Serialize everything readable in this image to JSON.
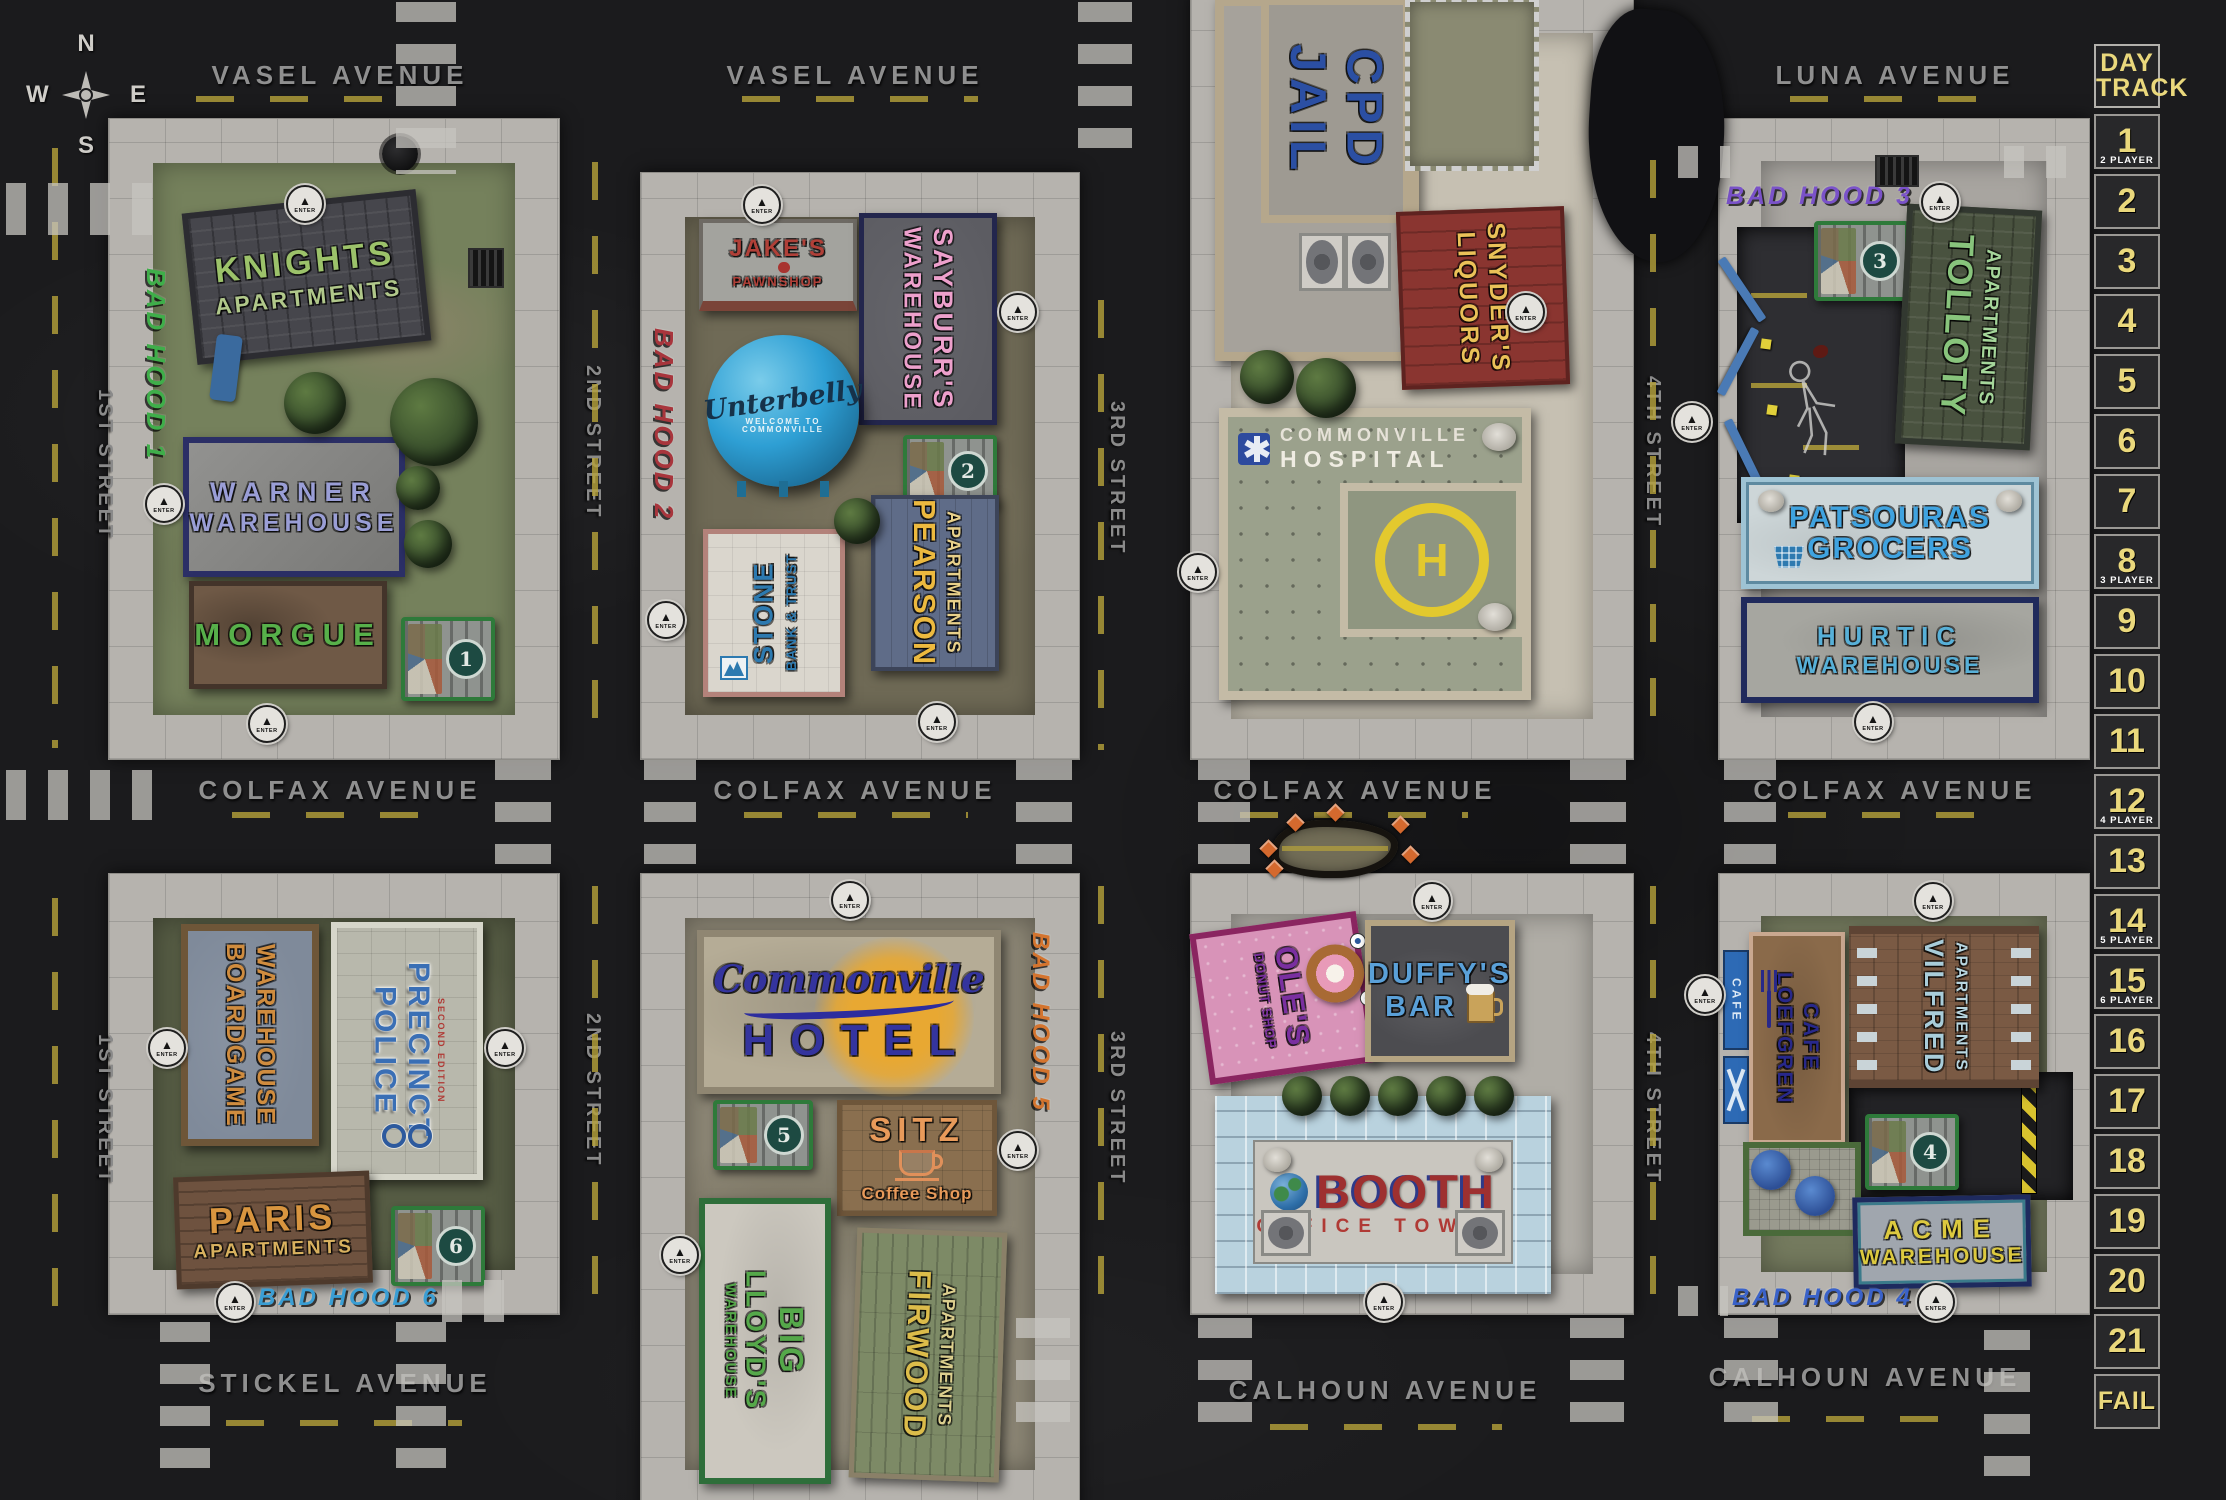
{
  "palette": {
    "asphalt": "#1b1b1d",
    "sidewalk": "#b6b3ae",
    "track_yellow": "#ead87c",
    "dash_yellow": "#b6a23a",
    "enter_marker": "#e4e2dd"
  },
  "compass": {
    "n": "N",
    "e": "E",
    "s": "S",
    "w": "W"
  },
  "streets": {
    "vasel_w": "VASEL AVENUE",
    "vasel_e": "VASEL AVENUE",
    "luna": "LUNA AVENUE",
    "colfax_1": "COLFAX AVENUE",
    "colfax_2": "COLFAX AVENUE",
    "colfax_3": "COLFAX AVENUE",
    "colfax_4": "COLFAX AVENUE",
    "stickel": "STICKEL AVENUE",
    "calhoun_1": "CALHOUN AVENUE",
    "calhoun_2": "CALHOUN AVENUE",
    "first_u": "1ST STREET",
    "first_l": "1ST STREET",
    "second_u": "2ND STREET",
    "second_l": "2ND STREET",
    "third_u": "3RD STREET",
    "third_l": "3RD STREET",
    "fourth_u": "4TH STREET",
    "fourth_l": "4TH STREET"
  },
  "graffiti": {
    "hood1": "BAD HOOD 1",
    "hood2": "BAD HOOD 2",
    "hood3": "BAD HOOD 3",
    "hood4": "BAD HOOD 4",
    "hood5": "BAD HOOD 5",
    "hood6": "BAD HOOD 6"
  },
  "markers": {
    "enter": "ENTER"
  },
  "day_track": {
    "title_l1": "DAY",
    "title_l2": "TRACK",
    "cells": [
      {
        "n": "1",
        "sub": "2 PLAYER"
      },
      {
        "n": "2"
      },
      {
        "n": "3"
      },
      {
        "n": "4"
      },
      {
        "n": "5"
      },
      {
        "n": "6"
      },
      {
        "n": "7"
      },
      {
        "n": "8",
        "sub": "3 PLAYER"
      },
      {
        "n": "9"
      },
      {
        "n": "10"
      },
      {
        "n": "11"
      },
      {
        "n": "12",
        "sub": "4 PLAYER"
      },
      {
        "n": "13"
      },
      {
        "n": "14",
        "sub": "5 PLAYER"
      },
      {
        "n": "15",
        "sub": "6 PLAYER"
      },
      {
        "n": "16"
      },
      {
        "n": "17"
      },
      {
        "n": "18"
      },
      {
        "n": "19"
      },
      {
        "n": "20"
      },
      {
        "n": "21"
      },
      {
        "n": "FAIL"
      }
    ]
  },
  "blocks": {
    "b1": {
      "knights": {
        "l1": "KNIGHTS",
        "l2": "APARTMENTS"
      },
      "warner": {
        "l1": "WARNER",
        "l2": "WAREHOUSE"
      },
      "morgue": {
        "l1": "MORGUE"
      },
      "dumpster": "1"
    },
    "b2": {
      "jakes": {
        "l1": "JAKE'S",
        "l2": "PAWNSHOP"
      },
      "sayburrs": {
        "l1": "SAYBURR'S",
        "l2": "WAREHOUSE"
      },
      "unterbelly": {
        "l1": "Unterbelly",
        "sub": "WELCOME TO COMMONVILLE"
      },
      "stone": {
        "l1": "STONE",
        "l2": "BANK & TRUST"
      },
      "pearson": {
        "l1": "PEARSON",
        "l2": "APARTMENTS"
      },
      "dumpster": "2"
    },
    "b3": {
      "jail": {
        "l1": "CPD",
        "l2": "JAIL"
      },
      "snyders": {
        "l1": "SNYDER'S",
        "l2": "LIQUORS"
      },
      "hospital": {
        "l1": "COMMONVILLE",
        "l2": "HOSPITAL",
        "helipad": "H"
      }
    },
    "b4": {
      "tolloty": {
        "l1": "TOLLOTY",
        "l2": "APARTMENTS"
      },
      "patsouras": {
        "l1": "PATSOURAS",
        "l2": "GROCERS"
      },
      "hurtic": {
        "l1": "HURTIC",
        "l2": "WAREHOUSE"
      },
      "dumpster": "3"
    },
    "b5": {
      "boardgame": {
        "l1": "BOARDGAME",
        "l2": "WAREHOUSE"
      },
      "police": {
        "l1": "POLICE",
        "l2": "PRECINCT",
        "sub": "SECOND EDITION"
      },
      "paris": {
        "l1": "PARIS",
        "l2": "APARTMENTS"
      },
      "dumpster": "6"
    },
    "b6": {
      "hotel": {
        "l1": "Commonville",
        "l2": "HOTEL"
      },
      "sitz": {
        "l1": "SITZ",
        "l2": "Coffee Shop"
      },
      "biglloyds": {
        "l1": "BIG",
        "l2": "LLOYD'S",
        "l3": "WAREHOUSE"
      },
      "firwood": {
        "l1": "FIRWOOD",
        "l2": "APARTMENTS"
      },
      "dumpster": "5"
    },
    "b7": {
      "oles": {
        "l1": "OLE'S",
        "l2": "DONUT SHOP"
      },
      "duffys": {
        "l1": "DUFFY'S",
        "l2": "BAR"
      },
      "booth": {
        "l1": "BOOTH",
        "l2": "OFFICE TOWER"
      }
    },
    "b8": {
      "loefgren": {
        "l1": "LOEFGREN",
        "l2": "CAFE"
      },
      "cafe_sign": "CAFE",
      "vilfred": {
        "l1": "VILFRED",
        "l2": "APARTMENTS"
      },
      "acme": {
        "l1": "ACME",
        "l2": "WAREHOUSE"
      },
      "dumpster": "4"
    }
  }
}
